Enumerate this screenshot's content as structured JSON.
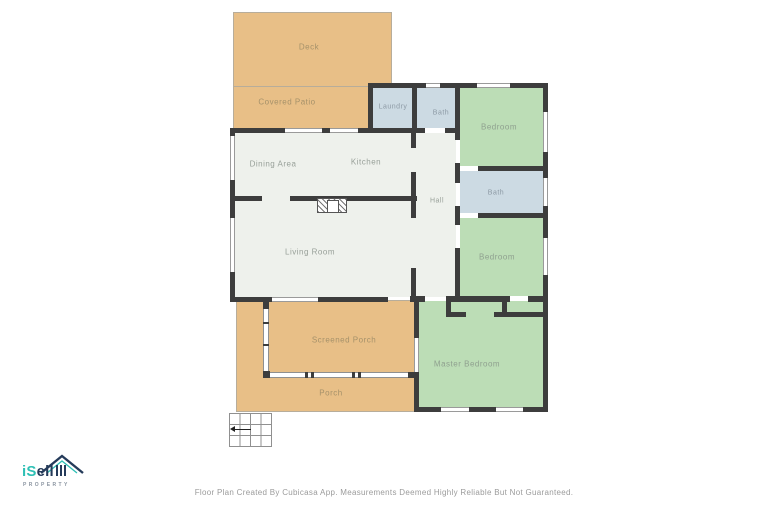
{
  "palette": {
    "wall": "#3d3d3d",
    "deck_patio_porch": "#e8bf87",
    "bedroom_green": "#bcddb6",
    "bath_laundry_blue": "#ccdae3",
    "interior_white": "#eef1ec",
    "logo_teal": "#2ec0b5",
    "logo_navy": "#253b5a",
    "footer_gray": "#9b9b9b"
  },
  "floor_plan": {
    "rooms": {
      "deck": {
        "label": "Deck"
      },
      "covered_patio": {
        "label": "Covered Patio"
      },
      "laundry": {
        "label": "Laundry"
      },
      "bath_top": {
        "label": "Bath"
      },
      "bedroom_top": {
        "label": "Bedroom"
      },
      "dining_area": {
        "label": "Dining Area"
      },
      "kitchen": {
        "label": "Kitchen"
      },
      "hall": {
        "label": "Hall"
      },
      "bath_right": {
        "label": "Bath"
      },
      "bedroom_middle": {
        "label": "Bedroom"
      },
      "living_room": {
        "label": "Living Room"
      },
      "screened_porch": {
        "label": "Screened Porch"
      },
      "master_bedroom": {
        "label": "Master Bedroom"
      },
      "porch": {
        "label": "Porch"
      }
    }
  },
  "branding": {
    "name_i": "i",
    "name_s": "S",
    "name_rest": "ell",
    "tagline": "PROPERTY"
  },
  "footer": {
    "disclaimer": "Floor Plan Created By Cubicasa App. Measurements Deemed Highly Reliable But Not Guaranteed."
  }
}
